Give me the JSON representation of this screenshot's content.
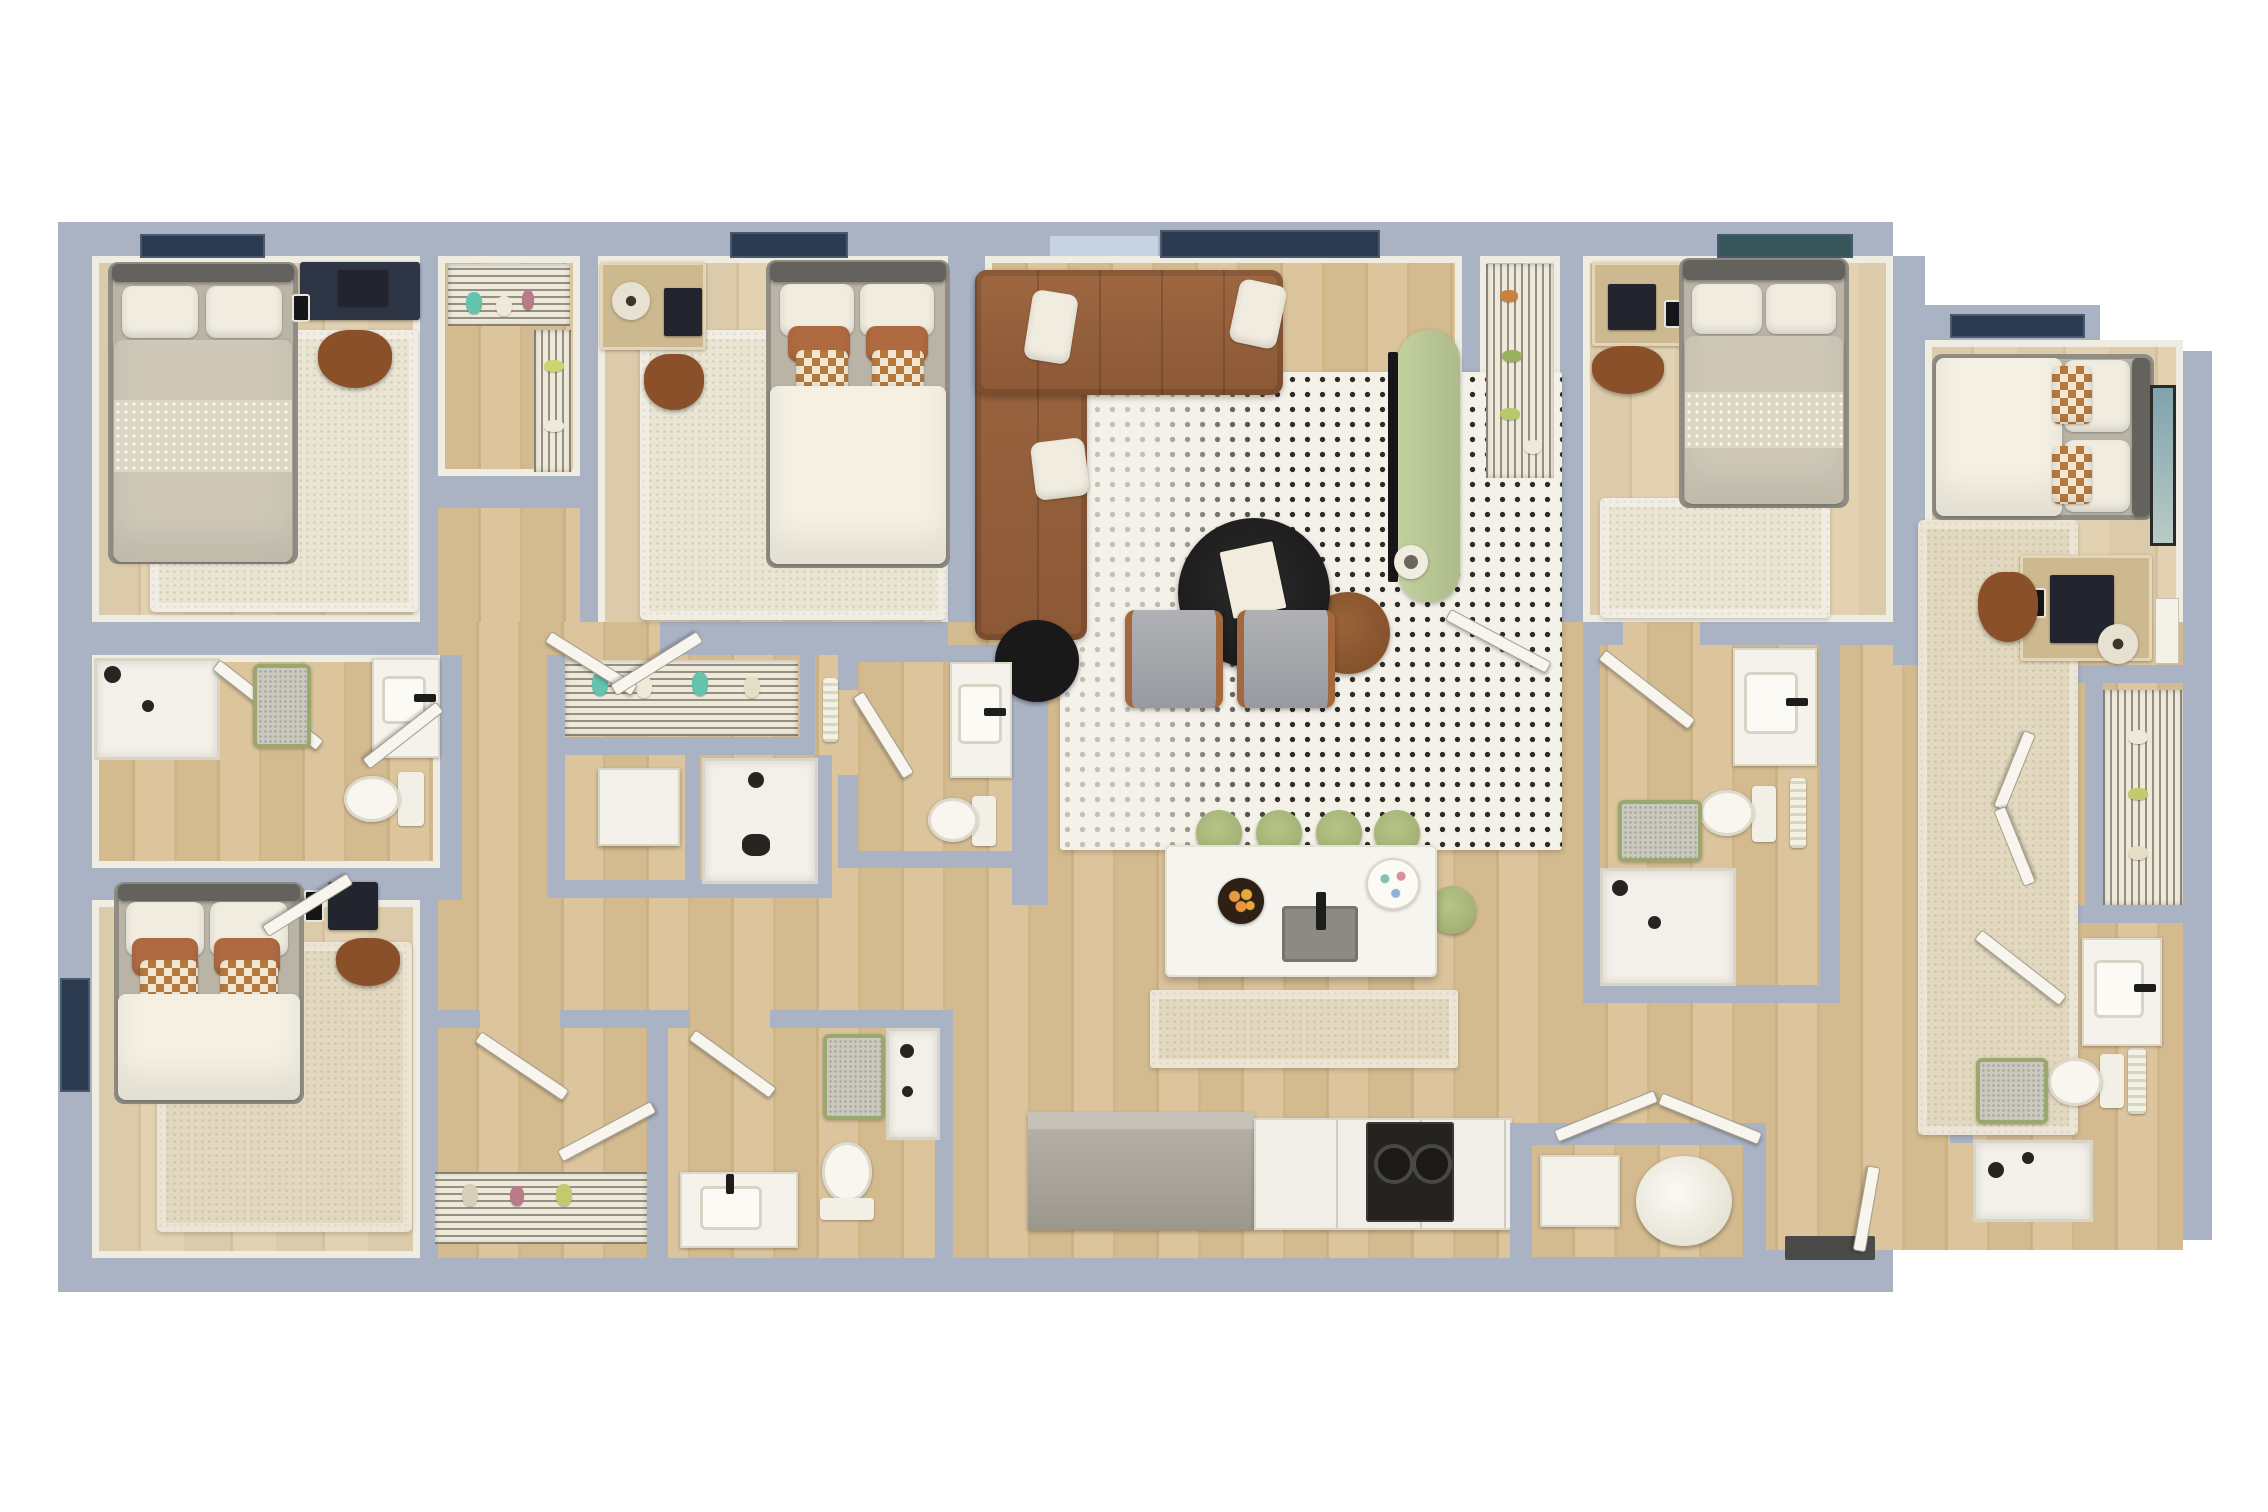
{
  "title": "4-bedroom apartment 3D floor plan (top-down render)",
  "palette": {
    "wall": "#a9b3c4",
    "wood_floor": "#d3ba8f",
    "pale_floor": "#dccbaa",
    "wall_liner": "#efece1",
    "rug_cream": "#eae4d3",
    "rug_beige": "#e2d8bf",
    "duvet_white": "#f4f0e3",
    "pillow_rust": "#b06a42",
    "sofa_brown": "#96613d",
    "console_green": "#b7c795",
    "stool_green": "#a9b87c",
    "window_navy": "#2c3a50",
    "appliance_black": "#1f1f1f",
    "counter_gray": "#b5b0a7",
    "fixture_white": "#f5f3ec"
  },
  "rooms": [
    {
      "name": "bedroom-top-left",
      "furniture": [
        "double-bed",
        "navy-desk",
        "laptop",
        "desk-chair",
        "cream-rug",
        "window-art"
      ]
    },
    {
      "name": "walk-in-closet-1",
      "furniture": [
        "wire-shelving",
        "hanging-clothes"
      ]
    },
    {
      "name": "bedroom-top-middle",
      "furniture": [
        "double-bed",
        "desk",
        "lamp",
        "laptop",
        "desk-chair",
        "white-rug",
        "window"
      ]
    },
    {
      "name": "living-room",
      "furniture": [
        "l-shaped-leather-sectional",
        "throw-pillows",
        "black-coffee-table",
        "book",
        "side-table",
        "black-pouf",
        "two-gray-armchairs",
        "dotted-pattern-rug",
        "green-tv-console",
        "tv",
        "vase",
        "windows"
      ]
    },
    {
      "name": "plant-storage-closet",
      "furniture": [
        "wire-shelving"
      ]
    },
    {
      "name": "bedroom-top-right",
      "furniture": [
        "double-bed",
        "desk",
        "laptop",
        "desk-chair",
        "cream-rug",
        "window"
      ]
    },
    {
      "name": "bedroom-far-right",
      "furniture": [
        "double-bed",
        "desk",
        "monitor",
        "desk-chair",
        "floor-lamp",
        "wall-art",
        "beige-rug",
        "window"
      ]
    },
    {
      "name": "bathroom-left",
      "furniture": [
        "walk-in-shower",
        "glass-door",
        "vanity-sink",
        "toilet",
        "bath-mat"
      ]
    },
    {
      "name": "bedroom-bottom-left",
      "furniture": [
        "double-bed",
        "desk",
        "laptop",
        "desk-chair",
        "beige-rug",
        "window"
      ]
    },
    {
      "name": "hall-closet-row",
      "furniture": [
        "wire-shelving",
        "hanging-clothes"
      ]
    },
    {
      "name": "utility-closet",
      "furniture": [
        "white-cabinet"
      ]
    },
    {
      "name": "shower-room-middle",
      "furniture": [
        "walk-in-shower",
        "hand-towel"
      ]
    },
    {
      "name": "powder-bathroom-middle",
      "furniture": [
        "vanity-sink",
        "toilet"
      ]
    },
    {
      "name": "kitchen",
      "furniture": [
        "white-island",
        "five-green-stools",
        "fruit-bowl",
        "island-sink",
        "serving-tray",
        "refrigerator",
        "cooktop-range",
        "white-cabinets",
        "runner-rug"
      ]
    },
    {
      "name": "laundry-closet",
      "furniture": [
        "washer-drum",
        "dryer-box",
        "bifold-doors",
        "doormat"
      ]
    },
    {
      "name": "bottom-closet-room",
      "furniture": [
        "double-doors",
        "wire-shelving"
      ]
    },
    {
      "name": "bathroom-bottom-middle",
      "furniture": [
        "vanity-sink",
        "toilet",
        "shower",
        "bath-mat"
      ]
    },
    {
      "name": "bathroom-middle-right",
      "furniture": [
        "vanity-sink",
        "toilet",
        "towel-rack",
        "bath-mat",
        "walk-in-shower"
      ]
    },
    {
      "name": "hallway-right",
      "furniture": [
        "bifold-closet-doors",
        "reach-in-closet"
      ]
    },
    {
      "name": "bathroom-far-right",
      "furniture": [
        "vanity-sink",
        "toilet",
        "towel-rack",
        "bath-mat",
        "walk-in-shower"
      ]
    }
  ]
}
